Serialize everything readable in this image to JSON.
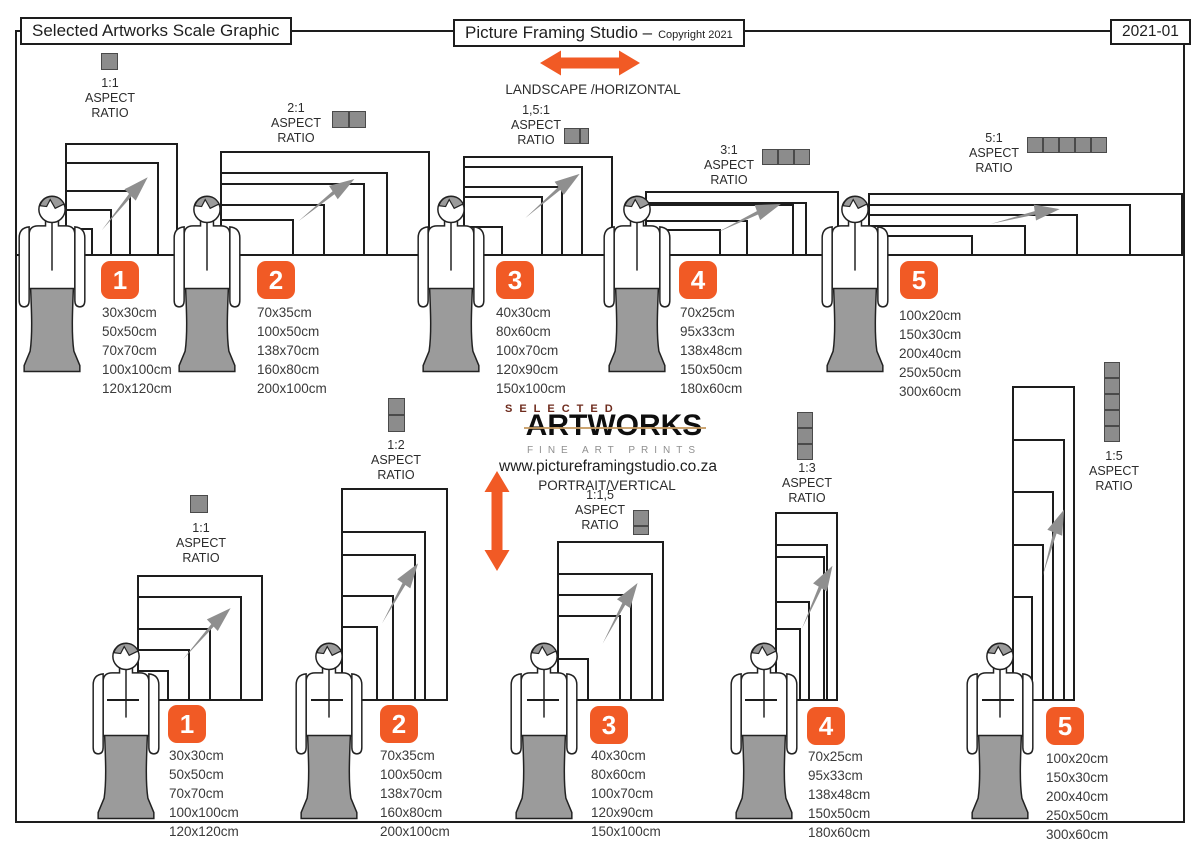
{
  "header": {
    "title": "Selected Artworks Scale Graphic",
    "studio": "Picture Framing Studio –",
    "copyright": "Copyright 2021",
    "version": "2021-01"
  },
  "labels": {
    "aspect": "ASPECT",
    "ratio": "RATIO"
  },
  "sections": {
    "landscape": "LANDSCAPE /HORIZONTAL",
    "portrait": "PORTRAIT/VERTICAL"
  },
  "logo": {
    "selected": "SELECTED",
    "artworks": "ARTWORKS",
    "tagline": "FINE ART PRINTS",
    "website": "www.pictureframingstudio.co.za"
  },
  "colors": {
    "accent_orange": "#F15A25",
    "figure_gray": "#9B9B9B",
    "icon_gray": "#8C8C8C",
    "line_black": "#1D1D1D"
  },
  "groups": {
    "landscape": [
      {
        "number": "1",
        "ratio": "1:1",
        "sizes": [
          "30x30cm",
          "50x50cm",
          "70x70cm",
          "100x100cm",
          "120x120cm"
        ]
      },
      {
        "number": "2",
        "ratio": "2:1",
        "sizes": [
          "70x35cm",
          "100x50cm",
          "138x70cm",
          "160x80cm",
          "200x100cm"
        ]
      },
      {
        "number": "3",
        "ratio": "1,5:1",
        "sizes": [
          "40x30cm",
          "80x60cm",
          "100x70cm",
          "120x90cm",
          "150x100cm"
        ]
      },
      {
        "number": "4",
        "ratio": "3:1",
        "sizes": [
          "70x25cm",
          "95x33cm",
          "138x48cm",
          "150x50cm",
          "180x60cm"
        ]
      },
      {
        "number": "5",
        "ratio": "5:1",
        "sizes": [
          "100x20cm",
          "150x30cm",
          "200x40cm",
          "250x50cm",
          "300x60cm"
        ]
      }
    ],
    "portrait": [
      {
        "number": "1",
        "ratio": "1:1",
        "sizes": [
          "30x30cm",
          "50x50cm",
          "70x70cm",
          "100x100cm",
          "120x120cm"
        ]
      },
      {
        "number": "2",
        "ratio": "1:2",
        "sizes": [
          "70x35cm",
          "100x50cm",
          "138x70cm",
          "160x80cm",
          "200x100cm"
        ]
      },
      {
        "number": "3",
        "ratio": "1:1,5",
        "sizes": [
          "40x30cm",
          "80x60cm",
          "100x70cm",
          "120x90cm",
          "150x100cm"
        ]
      },
      {
        "number": "4",
        "ratio": "1:3",
        "sizes": [
          "70x25cm",
          "95x33cm",
          "138x48cm",
          "150x50cm",
          "180x60cm"
        ]
      },
      {
        "number": "5",
        "ratio": "1:5",
        "sizes": [
          "100x20cm",
          "150x30cm",
          "200x40cm",
          "250x50cm",
          "300x60cm"
        ]
      }
    ]
  }
}
